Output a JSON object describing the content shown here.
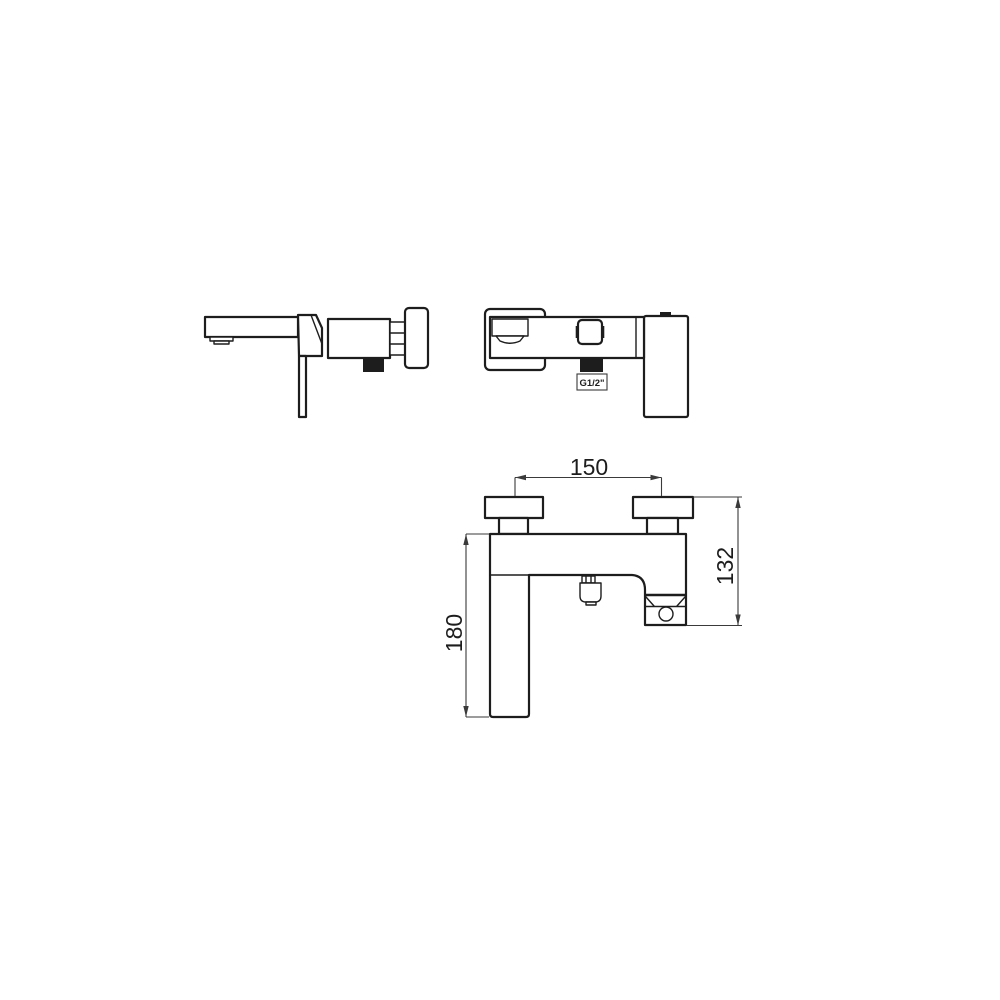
{
  "dimensions": {
    "span": "150",
    "height": "132",
    "drop": "180",
    "thread": "G1/2\""
  },
  "colors": {
    "line": "#1d1d1d",
    "dim": "#3a3a3a",
    "background": "#ffffff"
  }
}
